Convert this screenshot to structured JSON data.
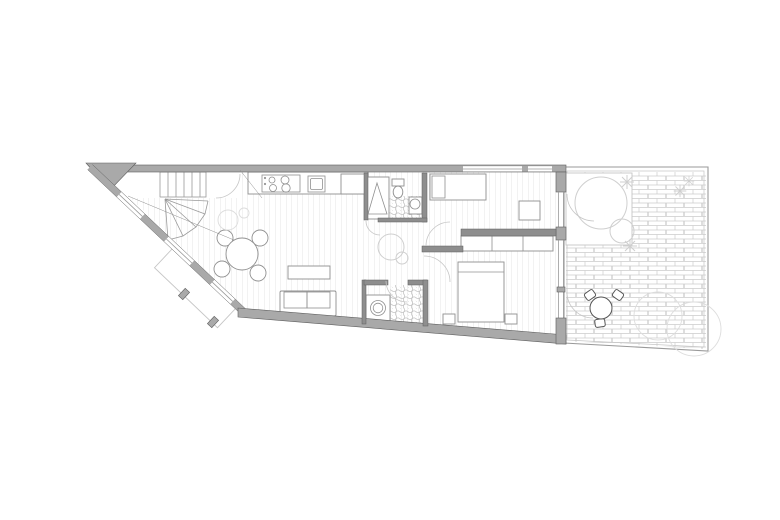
{
  "document": {
    "type": "architectural-floor-plan",
    "view": "top-down-plan",
    "has_text": false
  },
  "colors": {
    "background": "#ffffff",
    "wall": "#a9a9a9",
    "wall_dark": "#8e8e8e",
    "wall_outline": "#5f5f5f",
    "line": "#9a9a9a",
    "light_line": "#c6c6c6",
    "floor_line": "#e4e4e4",
    "brick_line": "#cccccc",
    "tile_line": "#bfbfbf",
    "vegetation": "#cfcfcf",
    "furniture_line": "#909090",
    "chair_dark": "#555555"
  },
  "plan": {
    "rooms": [
      {
        "name": "entry-hall"
      },
      {
        "name": "staircase"
      },
      {
        "name": "kitchen"
      },
      {
        "name": "living-dining-room"
      },
      {
        "name": "bathroom"
      },
      {
        "name": "hallway"
      },
      {
        "name": "laundry-room"
      },
      {
        "name": "bedroom-1"
      },
      {
        "name": "bedroom-2"
      },
      {
        "name": "balcony"
      },
      {
        "name": "terrace"
      },
      {
        "name": "patio-garden"
      }
    ],
    "fixtures": [
      "stove-4-burners",
      "kitchen-sink",
      "refrigerator",
      "shower-tray",
      "toilet",
      "washbasin",
      "washing-machine"
    ],
    "furniture": [
      "round-dining-table-with-4-chairs",
      "coffee-table",
      "two-seat-sofa",
      "single-bed",
      "desk",
      "built-in-wardrobe-3-sections",
      "double-bed",
      "two-nightstands",
      "patio-table-with-3-chairs"
    ],
    "landscape": [
      "brick-paving",
      "trees",
      "shrubs",
      "flower-plants"
    ]
  }
}
